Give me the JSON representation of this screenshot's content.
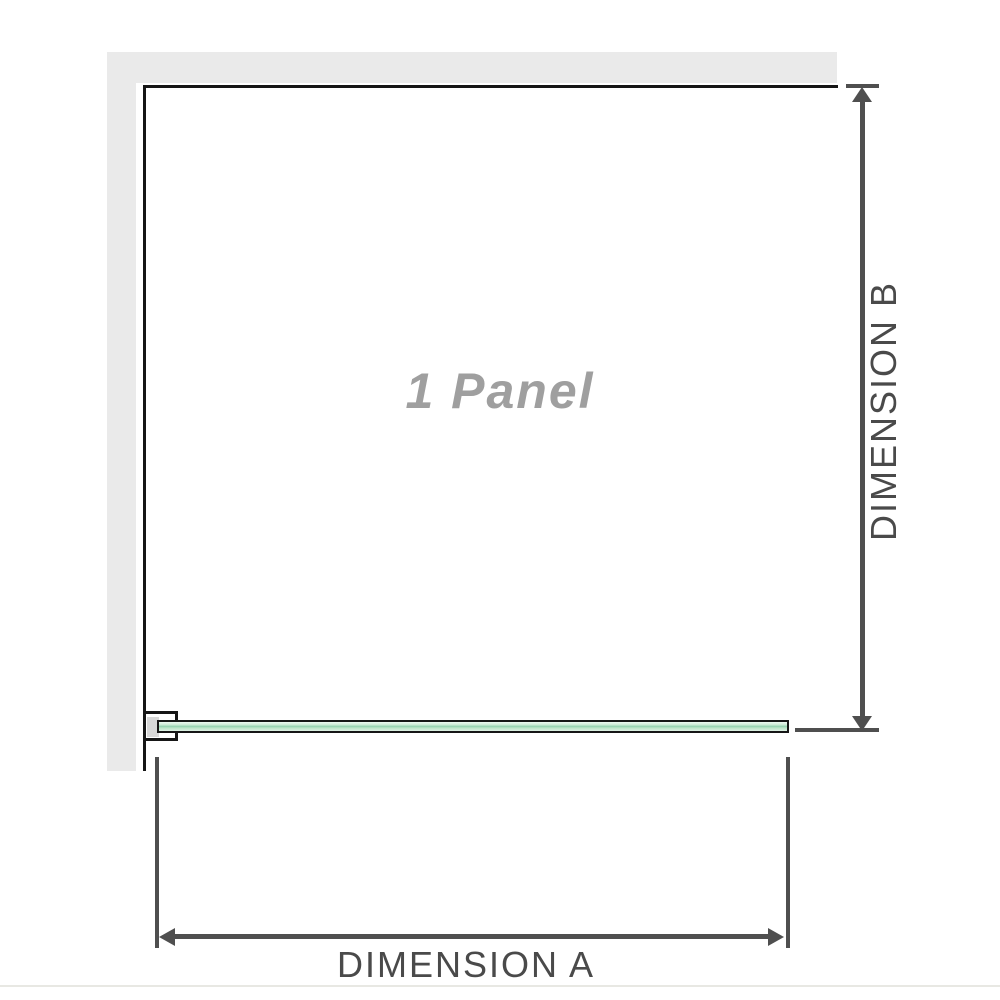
{
  "panel": {
    "label": "1 Panel"
  },
  "dimensions": {
    "a": {
      "label": "DIMENSION A"
    },
    "b": {
      "label": "DIMENSION B"
    }
  },
  "colors": {
    "wall_gray": "#eaeaea",
    "outline_black": "#161616",
    "dimension_gray": "#4f4f4f",
    "label_text_gray": "#4a4a4a",
    "panel_label_gray": "#9f9f9f",
    "glass_green_light": "#dff1e4",
    "glass_green_dark": "#93d1ae",
    "bracket_shim_gray": "#d8d8d8",
    "baseline_gray": "#e8e8e3"
  }
}
